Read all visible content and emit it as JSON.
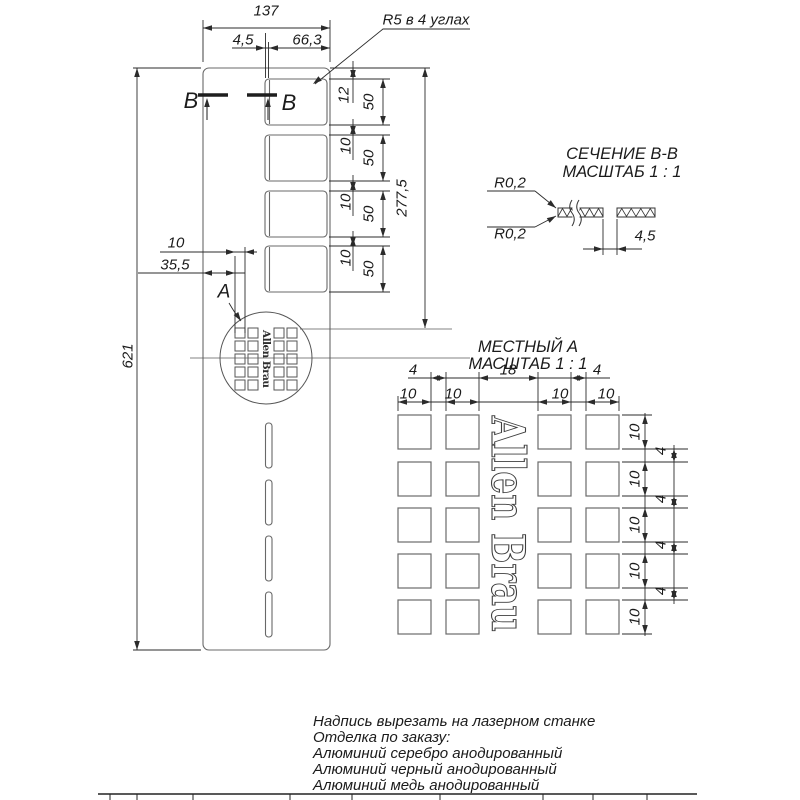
{
  "main_view": {
    "dim_width_total": "137",
    "dim_lip": "4,5",
    "dim_slot_width": "66,3",
    "corner_radius_note": "R5 в 4 углах",
    "section_cut_label": "B",
    "dim_first_slot_offset": "12",
    "slot_height_dims": [
      "50",
      "50",
      "50",
      "50"
    ],
    "slot_gap_dims": [
      "10",
      "10",
      "10"
    ],
    "dim_top_to_grid": "277,5",
    "dim_total_length": "621",
    "dim_grid_square": "10",
    "dim_grid_offset": "35,5",
    "detail_label": "A",
    "logo_text": "Allen Brau"
  },
  "section_view": {
    "title": "СЕЧЕНИЕ В-В",
    "scale_note": "МАСШТАБ 1 : 1",
    "radius_top": "R0,2",
    "radius_bottom": "R0,2",
    "dim_slot": "4,5"
  },
  "detail_view": {
    "title": "МЕСТНЫЙ А",
    "scale_note": "МАСШТАБ 1 : 1",
    "top_gap_dims": [
      "4",
      "18",
      "4"
    ],
    "top_square_dims": [
      "10",
      "10",
      "10",
      "10"
    ],
    "side_square_dims": [
      "10",
      "10",
      "10",
      "10",
      "10"
    ],
    "side_gap_dims": [
      "4",
      "4",
      "4",
      "4"
    ],
    "logo_text": "Allen Brau"
  },
  "notes": [
    "Надпись вырезать на лазерном станке",
    "Отделка по заказу:",
    "Алюминий серебро анодированный",
    "Алюминий черный анодированный",
    "Алюминий медь анодированный"
  ]
}
